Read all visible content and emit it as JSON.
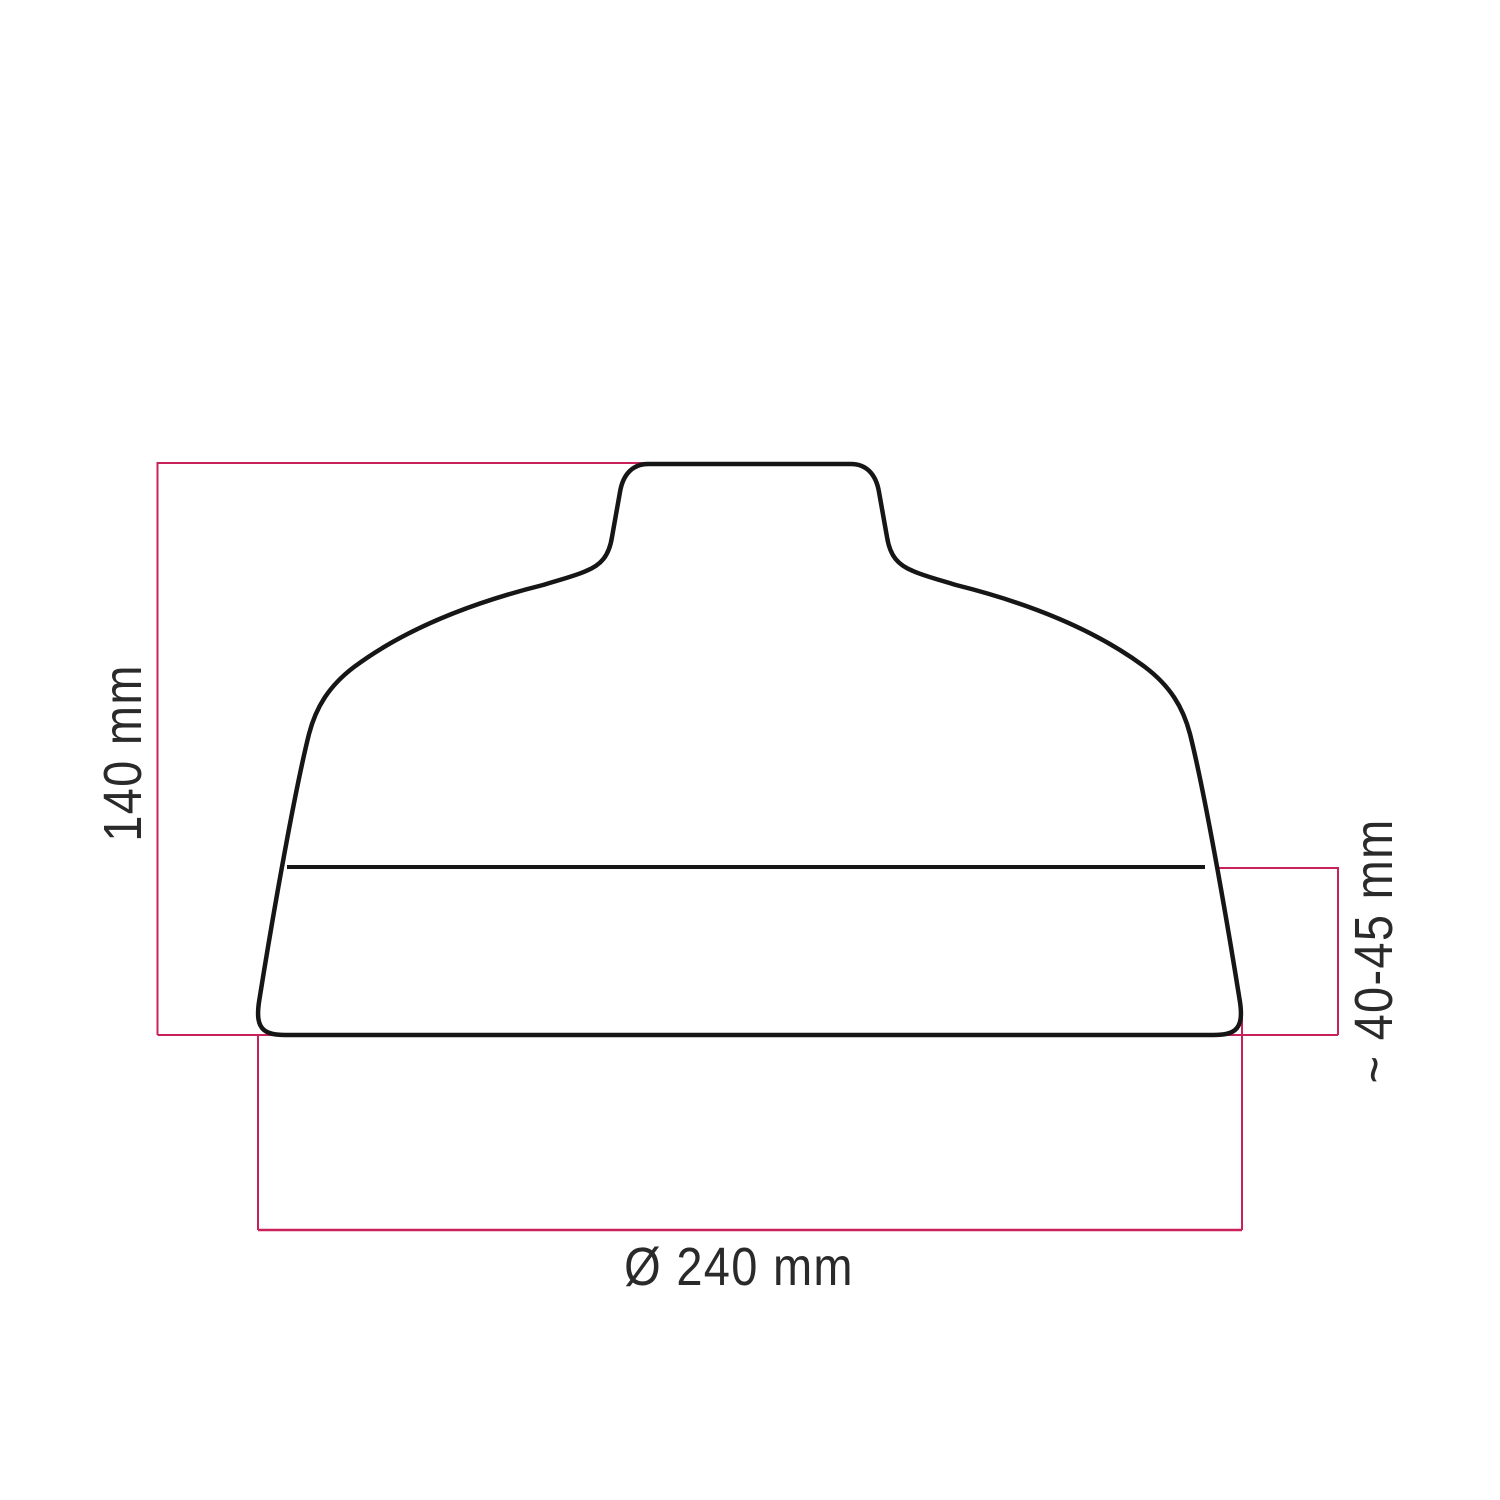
{
  "diagram": {
    "dimensions": {
      "height": "140 mm",
      "depth": "~ 40-45 mm",
      "diameter": "Ø 240 mm"
    },
    "colors": {
      "accent": "#c9215c",
      "outline": "#161616",
      "text": "#2a2a2a",
      "background": "#ffffff"
    }
  }
}
